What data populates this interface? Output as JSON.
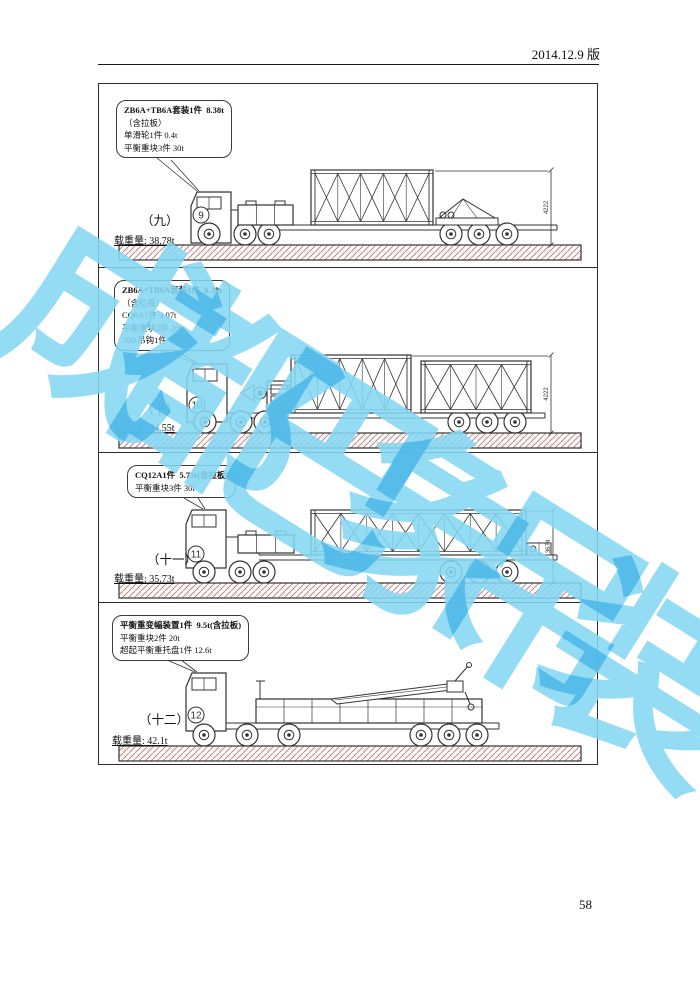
{
  "header": {
    "version_label": "2014.12.9 版"
  },
  "page_number": "58",
  "watermark": {
    "text": "成都巴象吊装",
    "color": "#85d6f3"
  },
  "hatch_color": "#c98080",
  "line_color": "#333333",
  "panels": [
    {
      "ordinal": "（九）",
      "truck_number": "9",
      "callout_lines": [
        "ZB6A+TB6A套装1件  8.38t",
        "（含拉板）",
        "单滑轮1件 0.4t",
        "平衡重块3件 30t"
      ],
      "weight_label": "载重量:",
      "weight_value": "38.78t",
      "height_dim": "4222"
    },
    {
      "ordinal": "（十）",
      "truck_number": "10",
      "callout_lines": [
        "ZB6A+TB6A套装1件  8.38t",
        "（含拉板）",
        "CQ6A1件 3.07t",
        "平衡重块2件 20t",
        "700t吊钩1件 13.1t"
      ],
      "weight_label": "载重量:",
      "weight_value": "44.55t",
      "height_dim": "4222"
    },
    {
      "ordinal": "（十一）",
      "truck_number": "11",
      "callout_lines": [
        "CQ12A1件  5.73t(含拉板)",
        "平衡重块3件 30t"
      ],
      "weight_label": "载重量:",
      "weight_value": "35.73t",
      "height_dim": "3674"
    },
    {
      "ordinal": "（十二）",
      "truck_number": "12",
      "callout_lines": [
        "平衡重变幅装置1件  9.5t(含拉板)",
        "平衡重块2件 20t",
        "超起平衡重托盘1件 12.6t"
      ],
      "weight_label": "载重量:",
      "weight_value": "42.1t",
      "height_dim": ""
    }
  ]
}
